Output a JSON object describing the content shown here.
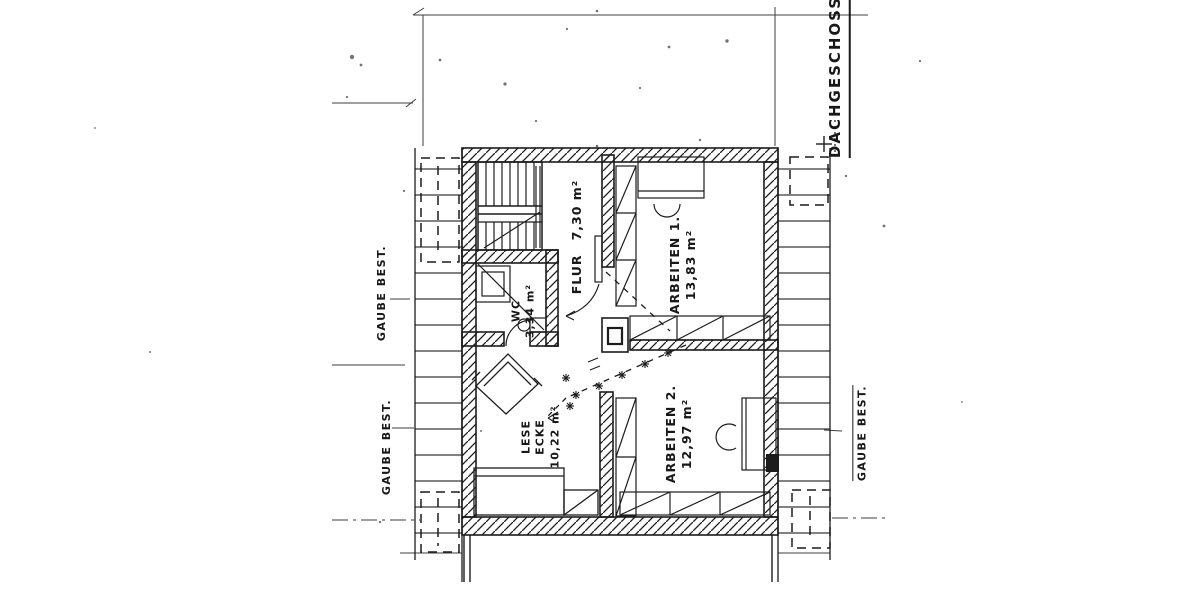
{
  "drawing_title": "DACHGESCHOSS",
  "rooms": {
    "flur": {
      "label": "FLUR",
      "area": "7,30 m²"
    },
    "arbeiten1": {
      "label": "ARBEITEN 1.",
      "area": "13,83 m²"
    },
    "arbeiten2": {
      "label": "ARBEITEN 2.",
      "area": "12,97 m²"
    },
    "wc": {
      "label": "WC",
      "area": "3,34 m²"
    },
    "lese_ecke": {
      "line1": "LESE",
      "line2": "ECKE",
      "area": "10,22 m²"
    }
  },
  "annotations": {
    "gaube_left_top": "GAUBE BEST.",
    "gaube_left_bottom": "GAUBE BEST.",
    "gaube_right": "GAUBE BEST."
  }
}
